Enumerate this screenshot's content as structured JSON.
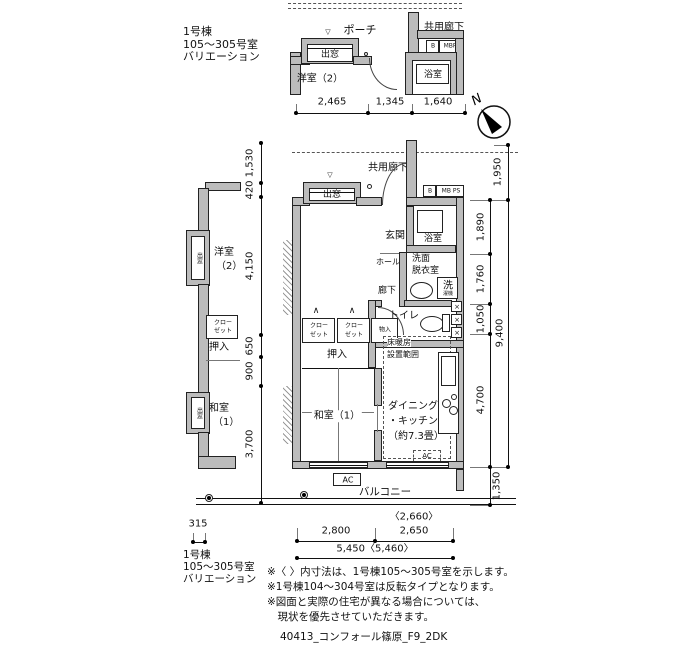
{
  "variation_label": {
    "line1": "1号棟",
    "line2": "105〜305号室",
    "line3": "バリエーション"
  },
  "north_label": "N",
  "top_plan": {
    "porch": "ポーチ",
    "common_corridor": "共用廊下",
    "bay_window": "出窓",
    "marker_triangle": "▽",
    "room": "洋室（2）",
    "bath": "浴室",
    "meter_b": "B",
    "meter_box": "MBPS"
  },
  "left_plan": {
    "bay_window_upper": "出窓",
    "bay_window_lower": "出窓",
    "western_room_l1": "洋室",
    "western_room_l2": "（2）",
    "closet_l1": "クロー",
    "closet_l2": "ゼット",
    "oshiire": "押入",
    "japanese_room_l1": "和室",
    "japanese_room_l2": "（1）"
  },
  "main_plan": {
    "common_corridor": "共用廊下",
    "bay_window": "出窓",
    "marker_triangle": "▽",
    "entrance": "玄関",
    "bath": "浴室",
    "meter_b": "B",
    "meter_box": "MB PS",
    "western_room_l1": "洋室（2）",
    "western_room_l2": "（約6.0畳）",
    "hall": "ホール",
    "washroom_l1": "洗面",
    "washroom_l2": "脱衣室",
    "laundry": "洗",
    "laundry_sub": "濯機",
    "corridor": "廊下",
    "toilet": "トイレ",
    "closet_l1": "クロー",
    "closet_l2": "ゼット",
    "storage": "物入",
    "oshiire": "押入",
    "japanese_room": "和室（1）",
    "heating_l1": "床暖房",
    "heating_l2": "設置範囲",
    "dk_l1": "ダイニング",
    "dk_l2": "・キッチン",
    "dk_l3": "（約7.3畳）",
    "ac": "AC",
    "balcony": "バルコニー",
    "shaft_mark": "×",
    "fold_mark": "∧"
  },
  "dims": {
    "top": [
      "2,465",
      "1,345",
      "1,640"
    ],
    "left": [
      "1,530",
      "420",
      "4,150",
      "650",
      "900",
      "3,700"
    ],
    "right": [
      "1,950",
      "1,890",
      "1,760",
      "1,050",
      "9,400",
      "4,700",
      "1,350"
    ],
    "bottom": {
      "seg1": "2,800",
      "seg2_alt": "〈2,660〉",
      "seg2": "2,650",
      "total": "5,450〈5,460〉",
      "side": "315"
    }
  },
  "bottom_label": {
    "line1": "1号棟",
    "line2": "105〜305号室",
    "line3": "バリエーション"
  },
  "notes": [
    "※〈 〉内寸法は、1号棟105〜305号室を示します。",
    "※1号棟104〜304号室は反転タイプとなります。",
    "※図面と実際の住宅が異なる場合については、",
    "　現状を優先させていただきます。"
  ],
  "footer": "40413_コンフォール篠原_F9_2DK"
}
